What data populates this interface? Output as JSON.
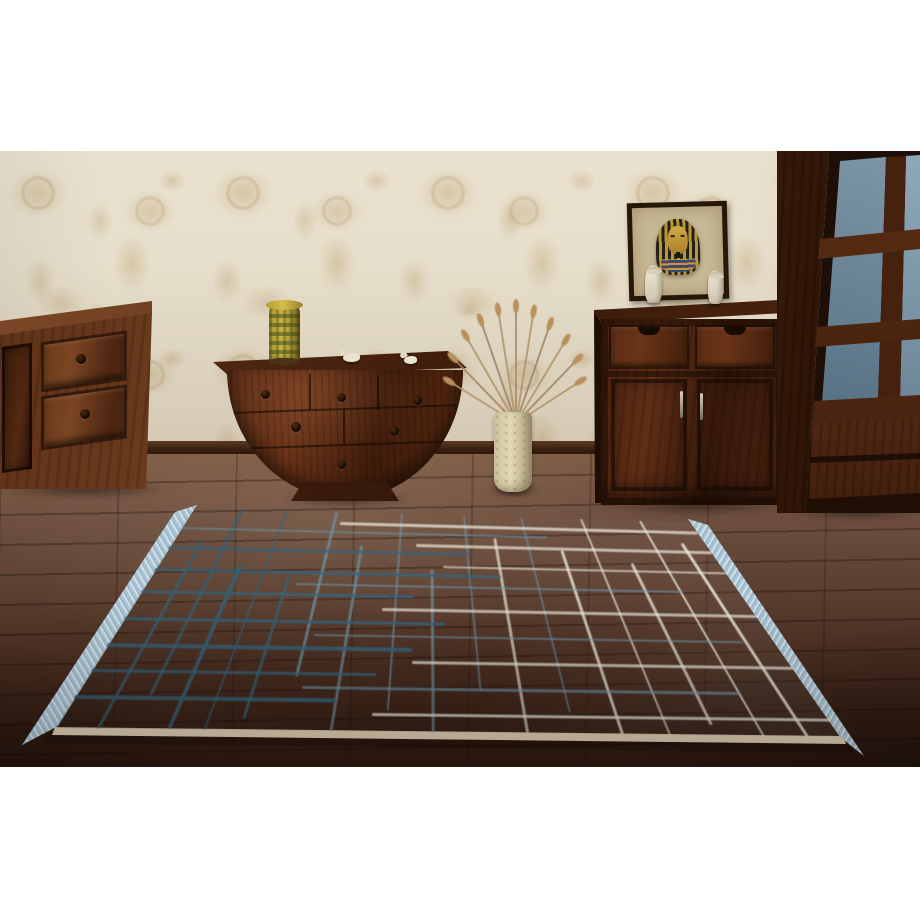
{
  "image": {
    "kind": "interior product photograph",
    "description": "Showroom photo of a grey-taupe flat rug with an irregular blue and white grid pattern and light-blue fringed short ends, lying on a dark brown plank floor in front of dark hardwood furniture against cream floral wallpaper. White margins above and below the photo."
  },
  "palette": {
    "page_background": "#ffffff",
    "wall_base": "#e7dfcb",
    "wall_motif": "#c1a475",
    "baseboard": "#3a2112",
    "floor_light": "#7d5b45",
    "floor_dark": "#2e1a10",
    "wood_dark": "#38190a",
    "wood_mid": "#6b3a1d",
    "rug_base": "#b0a392",
    "rug_teal": "#35647c",
    "rug_steel": "#6e94a9",
    "rug_white": "#e9e7db",
    "rug_fringe": "#a9c5d5",
    "rug_binding": "#dccdb4",
    "vase_yellow": "#cdb340",
    "glass_blue": "#7e98aa",
    "papyrus": "#c6b896"
  },
  "scene": {
    "wall": "cream wallpaper with tonal tan floral pattern",
    "floor": "dark reddish-brown wooden planks, darker toward the bottom corners",
    "furniture": [
      {
        "id": "dresser-left",
        "description": "medium-brown sideboard at far left, partially cropped, two drawers with dark ring pulls and a door"
      },
      {
        "id": "console-halfmoon",
        "description": "dark mahogany half-moon console with three small drawers over two wide drawers on a trapezoid pedestal"
      },
      {
        "id": "cabinet-right",
        "description": "dark chest with two scallop-notch drawers above two doors with silver bar handles"
      },
      {
        "id": "wardrobe-right",
        "description": "tall dark display cabinet with blue-grey glass panes and bottom drawers, cropped at right edge"
      }
    ],
    "decor": [
      {
        "id": "ceramic-vase",
        "description": "yellow-green patterned ceramic vase on the console"
      },
      {
        "id": "bird-figurines",
        "description": "two small white bird figurines on the console top"
      },
      {
        "id": "floor-vase",
        "description": "cream crackle cylinder vase with fanned dried teasel stalks"
      },
      {
        "id": "pharaoh-picture",
        "description": "framed papyrus of Tutankhamun's gold mask leaning on the chest"
      },
      {
        "id": "white-figurines",
        "description": "two small white seated figurines flanking the papyrus"
      }
    ]
  },
  "rug": {
    "description": "grey-taupe rug with sketchy grid: dark teal lines at left, steel-blue in the middle, white at right; light blue fringe on short ends, cream bottom binding",
    "quad": [
      [
        193,
        357
      ],
      [
        690,
        371
      ],
      [
        843,
        586
      ],
      [
        55,
        577
      ]
    ],
    "colors": {
      "teal": "#35647c",
      "steel": "#6e94a9",
      "white": "#e9e7db"
    },
    "vlines": [
      {
        "t": 0.055,
        "a": 0.15,
        "b": 1,
        "w": 3,
        "c": "teal",
        "o": 0.8
      },
      {
        "t": 0.1,
        "a": 0,
        "b": 0.85,
        "w": 2.5,
        "c": "teal",
        "o": 0.75
      },
      {
        "t": 0.145,
        "a": 0.25,
        "b": 1,
        "w": 3.5,
        "c": "teal",
        "o": 0.85
      },
      {
        "t": 0.19,
        "a": 0,
        "b": 1,
        "w": 2,
        "c": "teal",
        "o": 0.7
      },
      {
        "t": 0.235,
        "a": 0.3,
        "b": 0.95,
        "w": 3,
        "c": "teal",
        "o": 0.8
      },
      {
        "t": 0.29,
        "a": 0,
        "b": 0.75,
        "w": 2.5,
        "c": "steel",
        "o": 0.75
      },
      {
        "t": 0.35,
        "a": 0.15,
        "b": 1,
        "w": 2.5,
        "c": "steel",
        "o": 0.7
      },
      {
        "t": 0.42,
        "a": 0,
        "b": 0.9,
        "w": 2,
        "c": "steel",
        "o": 0.65
      },
      {
        "t": 0.48,
        "a": 0.25,
        "b": 1,
        "w": 3,
        "c": "steel",
        "o": 0.7
      },
      {
        "t": 0.545,
        "a": 0,
        "b": 0.8,
        "w": 2,
        "c": "steel",
        "o": 0.6
      },
      {
        "t": 0.6,
        "a": 0.1,
        "b": 1,
        "w": 2.5,
        "c": "white",
        "o": 0.7
      },
      {
        "t": 0.66,
        "a": 0,
        "b": 0.9,
        "w": 2,
        "c": "steel",
        "o": 0.55
      },
      {
        "t": 0.72,
        "a": 0.15,
        "b": 1,
        "w": 2.5,
        "c": "white",
        "o": 0.8
      },
      {
        "t": 0.78,
        "a": 0,
        "b": 1,
        "w": 2,
        "c": "white",
        "o": 0.7
      },
      {
        "t": 0.84,
        "a": 0.2,
        "b": 0.95,
        "w": 2.5,
        "c": "white",
        "o": 0.75
      },
      {
        "t": 0.9,
        "a": 0,
        "b": 1,
        "w": 2,
        "c": "white",
        "o": 0.8
      },
      {
        "t": 0.955,
        "a": 0.1,
        "b": 1,
        "w": 2.5,
        "c": "white",
        "o": 0.85
      }
    ],
    "hlines": [
      {
        "s": 0.05,
        "a": 0.3,
        "b": 1,
        "h": 2.5,
        "c": "white",
        "o": 0.75
      },
      {
        "s": 0.09,
        "a": 0,
        "b": 0.7,
        "h": 2,
        "c": "steel",
        "o": 0.6
      },
      {
        "s": 0.14,
        "a": 0.45,
        "b": 1,
        "h": 2.5,
        "c": "white",
        "o": 0.7
      },
      {
        "s": 0.18,
        "a": 0,
        "b": 0.55,
        "h": 2.5,
        "c": "teal",
        "o": 0.7
      },
      {
        "s": 0.24,
        "a": 0.5,
        "b": 1,
        "h": 2,
        "c": "white",
        "o": 0.65
      },
      {
        "s": 0.28,
        "a": 0,
        "b": 0.6,
        "h": 3,
        "c": "teal",
        "o": 0.75
      },
      {
        "s": 0.33,
        "a": 0.25,
        "b": 0.9,
        "h": 2,
        "c": "steel",
        "o": 0.6
      },
      {
        "s": 0.38,
        "a": 0,
        "b": 0.45,
        "h": 3,
        "c": "teal",
        "o": 0.8
      },
      {
        "s": 0.44,
        "a": 0.4,
        "b": 1,
        "h": 2.5,
        "c": "white",
        "o": 0.7
      },
      {
        "s": 0.5,
        "a": 0,
        "b": 0.5,
        "h": 3,
        "c": "teal",
        "o": 0.8
      },
      {
        "s": 0.56,
        "a": 0.3,
        "b": 0.95,
        "h": 2,
        "c": "steel",
        "o": 0.6
      },
      {
        "s": 0.62,
        "a": 0,
        "b": 0.45,
        "h": 3.5,
        "c": "teal",
        "o": 0.85
      },
      {
        "s": 0.68,
        "a": 0.45,
        "b": 1,
        "h": 2.5,
        "c": "white",
        "o": 0.75
      },
      {
        "s": 0.74,
        "a": 0,
        "b": 0.4,
        "h": 3,
        "c": "teal",
        "o": 0.8
      },
      {
        "s": 0.8,
        "a": 0.3,
        "b": 0.9,
        "h": 2.5,
        "c": "steel",
        "o": 0.65
      },
      {
        "s": 0.86,
        "a": 0,
        "b": 0.35,
        "h": 3.5,
        "c": "teal",
        "o": 0.85
      },
      {
        "s": 0.92,
        "a": 0.4,
        "b": 1,
        "h": 2.5,
        "c": "white",
        "o": 0.8
      }
    ]
  }
}
